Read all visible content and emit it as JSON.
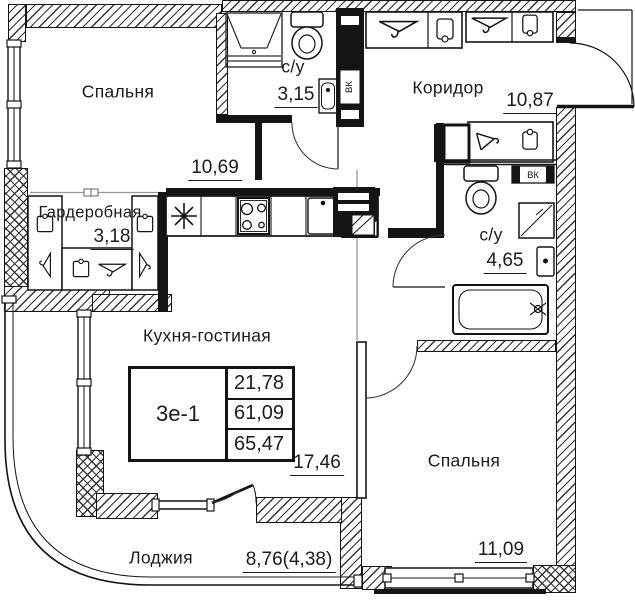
{
  "plan": {
    "type": "apartment-floor-plan",
    "rooms": [
      {
        "name": "Спальня",
        "area": "10,69"
      },
      {
        "name": "с/у",
        "area": "3,15"
      },
      {
        "name": "Коридор",
        "area": "10,87"
      },
      {
        "name": "Гардеробная",
        "area": "3,18"
      },
      {
        "name": "с/у",
        "area": "4,65"
      },
      {
        "name": "Кухня-гостиная",
        "area": "17,46"
      },
      {
        "name": "Спальня",
        "area": "11,09"
      },
      {
        "name": "Лоджия",
        "area": "8,76(4,38)"
      }
    ],
    "unit_table": {
      "unit_id": "3е-1",
      "values": [
        "21,78",
        "61,09",
        "65,47"
      ]
    },
    "shafts": {
      "vk1": "ВК",
      "vk2": "ВК"
    },
    "colors": {
      "line": "#141414",
      "zone_line": "#a0a0a0",
      "bg": "#ffffff"
    }
  }
}
